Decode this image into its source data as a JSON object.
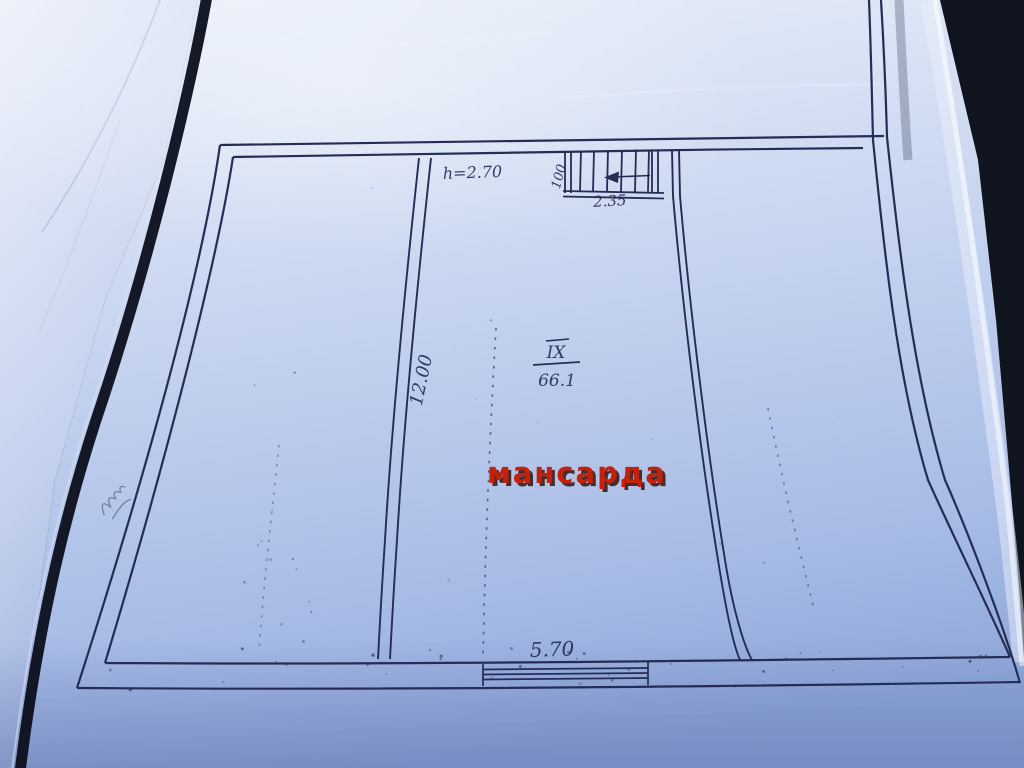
{
  "plan": {
    "watermark": "мансарда",
    "room": {
      "number": "IX",
      "area": "66.1"
    },
    "labels": {
      "ceiling_height": "h=2.70",
      "stair_width": "100",
      "stair_run": "2.35",
      "side_dimension": "12.00",
      "front_dimension": "5.70"
    },
    "colors": {
      "ink": "#262e58",
      "watermark_red": "#c5200c",
      "watermark_shadow": "#33150a",
      "paper_light": "#e8eef9",
      "paper_mid": "#c2d1ee",
      "paper_dark": "#8ea6d8",
      "background_fabric": "#10141f"
    }
  }
}
